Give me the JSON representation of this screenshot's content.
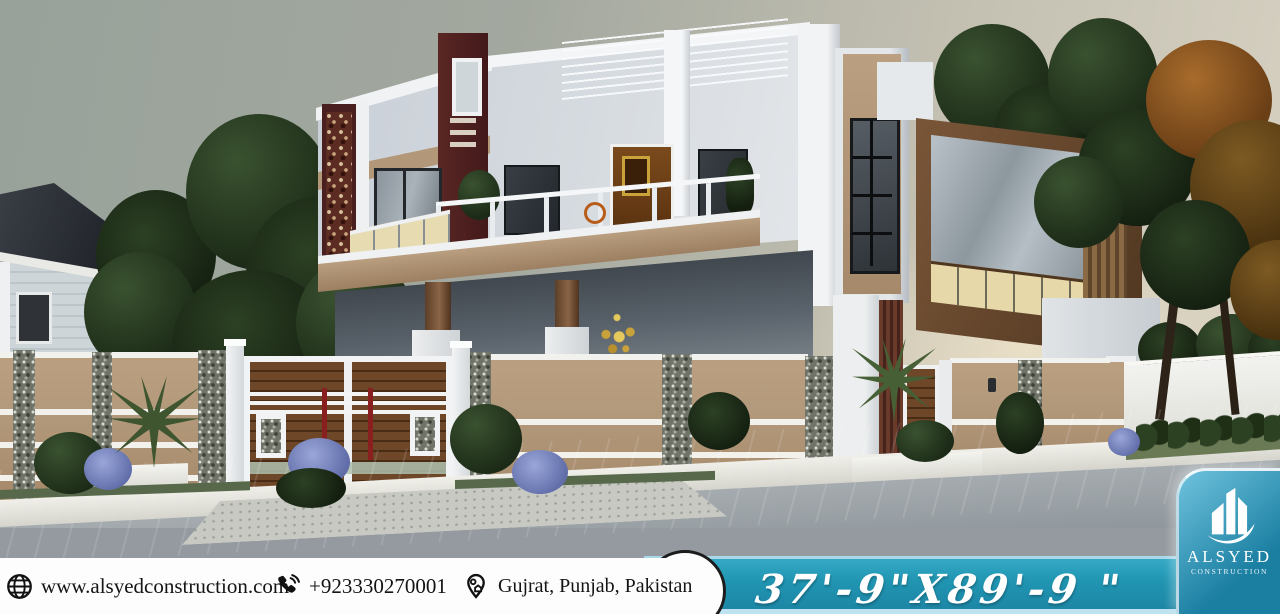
{
  "footer": {
    "contacts": [
      {
        "icon": "globe-icon",
        "label": "www.alsyedconstruction.com"
      },
      {
        "icon": "phone-icon",
        "label": "+923330270001"
      },
      {
        "icon": "location-pin-icon",
        "label": "Gujrat, Punjab, Pakistan"
      }
    ],
    "dimensions_text": "37'-9\"X89'-9 \""
  },
  "logo": {
    "name": "ALSYED",
    "subtitle": "CONSTRUCTION",
    "icon": "buildings-swoosh-icon"
  },
  "palette": {
    "footer_bg": "#fdfdfd",
    "footer_text": "#141414",
    "band_teal": "#2095b2",
    "band_edge_light": "#a9d8e8",
    "logo_teal_light": "#6fc3de",
    "logo_teal_dark": "#1b7fa2",
    "wall_tan": "#b3997b",
    "accent_maroon": "#4a1f1f",
    "wood_brown": "#6b4426",
    "balcony_cream": "#e7dbb2",
    "sky_grey": "#9ba49d",
    "sky_warm": "#e6ddca",
    "road_grey": "#9aa0a4",
    "foliage_dark": "#24351f",
    "foliage_autumn": "#8a5524",
    "stone_grey": "#777b72",
    "flower_purple": "#8490c8"
  }
}
